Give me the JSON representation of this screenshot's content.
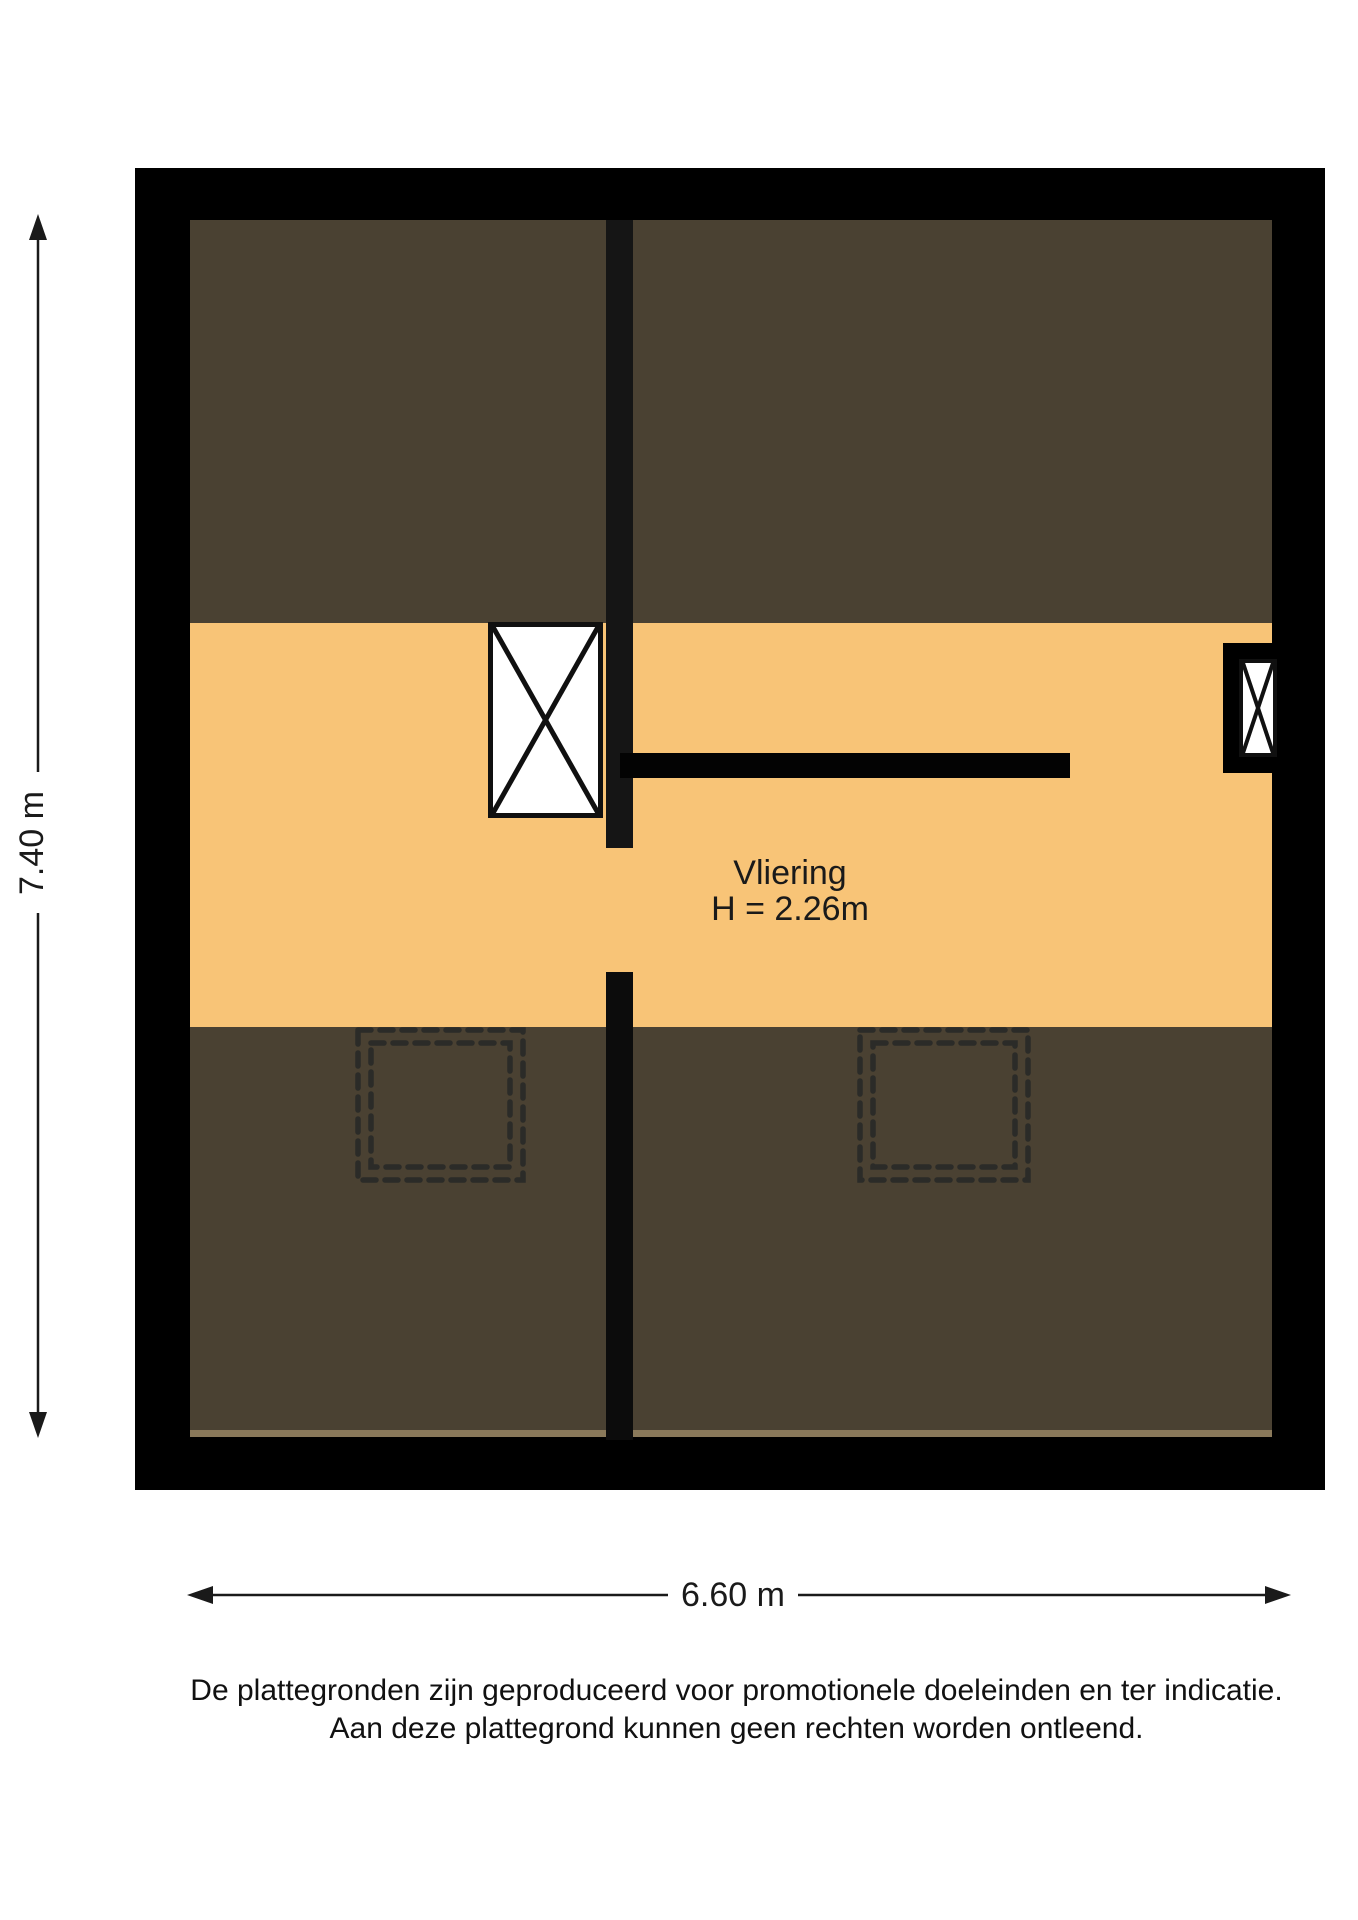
{
  "floorplan": {
    "room": {
      "name": "Vliering",
      "height_label": "H = 2.26m"
    },
    "dimensions": {
      "width_label": "6.60 m",
      "height_label": "7.40 m"
    },
    "colors": {
      "wall": "#000000",
      "roof_slope_area": "#4a4132",
      "floor_area": "#f8c477",
      "stair_fill": "#ffffff",
      "dashed_outline": "#2b2b28",
      "dimension_line": "#1a1a1a"
    },
    "symbols": {
      "staircase": "x-crossed-rectangle",
      "window": "x-crossed-rectangle",
      "roof_window": "double-dashed-square",
      "dimension": "double-headed-arrow"
    }
  },
  "disclaimer": {
    "line1": "De plattegronden zijn geproduceerd voor promotionele doeleinden en ter indicatie.",
    "line2": "Aan deze plattegrond kunnen geen rechten worden ontleend."
  }
}
